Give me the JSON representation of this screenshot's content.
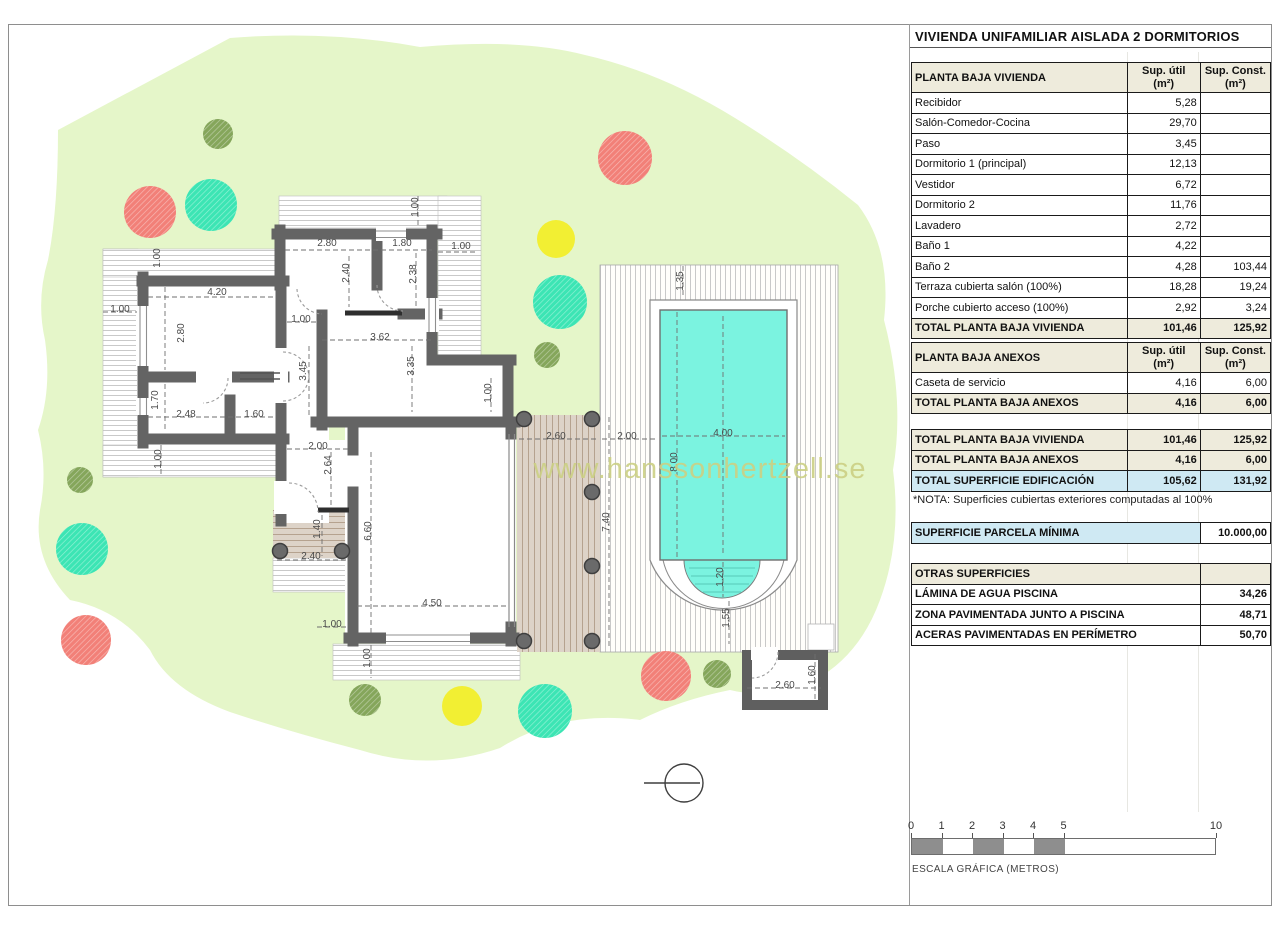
{
  "title": "VIVIENDA UNIFAMILIAR AISLADA 2 DORMITORIOS",
  "panel": {
    "vivienda": {
      "header": {
        "label": "PLANTA BAJA VIVIENDA",
        "col1": "Sup. útil\n(m²)",
        "col2": "Sup. Const.\n(m²)"
      },
      "rows": [
        [
          "Recibidor",
          "5,28",
          ""
        ],
        [
          "Salón-Comedor-Cocina",
          "29,70",
          ""
        ],
        [
          "Paso",
          "3,45",
          ""
        ],
        [
          "Dormitorio 1 (principal)",
          "12,13",
          ""
        ],
        [
          "Vestidor",
          "6,72",
          ""
        ],
        [
          "Dormitorio 2",
          "11,76",
          ""
        ],
        [
          "Lavadero",
          "2,72",
          ""
        ],
        [
          "Baño 1",
          "4,22",
          ""
        ],
        [
          "Baño 2",
          "4,28",
          "103,44"
        ],
        [
          "Terraza cubierta salón (100%)",
          "18,28",
          "19,24"
        ],
        [
          "Porche cubierto acceso (100%)",
          "2,92",
          "3,24"
        ]
      ],
      "total": [
        "TOTAL PLANTA BAJA VIVIENDA",
        "101,46",
        "125,92"
      ]
    },
    "anexos": {
      "header": {
        "label": "PLANTA BAJA ANEXOS",
        "col1": "Sup. útil\n(m²)",
        "col2": "Sup. Const.\n(m²)"
      },
      "rows": [
        [
          "Caseta de servicio",
          "4,16",
          "6,00"
        ]
      ],
      "total": [
        "TOTAL PLANTA BAJA ANEXOS",
        "4,16",
        "6,00"
      ]
    },
    "summary": [
      {
        "label": "TOTAL PLANTA BAJA VIVIENDA",
        "util": "101,46",
        "const": "125,92",
        "highlight": false
      },
      {
        "label": "TOTAL PLANTA BAJA ANEXOS",
        "util": "4,16",
        "const": "6,00",
        "highlight": false
      },
      {
        "label": "TOTAL SUPERFICIE EDIFICACIÓN",
        "util": "105,62",
        "const": "131,92",
        "highlight": true
      }
    ],
    "nota": "*NOTA: Superficies cubiertas exteriores computadas al 100%",
    "parcela": {
      "label": "SUPERFICIE PARCELA MÍNIMA",
      "value": "10.000,00"
    },
    "otras": {
      "header": "OTRAS SUPERFICIES",
      "rows": [
        [
          "LÁMINA DE AGUA PISCINA",
          "34,26"
        ],
        [
          "ZONA PAVIMENTADA JUNTO A PISCINA",
          "48,71"
        ],
        [
          "ACERAS PAVIMENTADAS EN PERÍMETRO",
          "50,70"
        ]
      ]
    }
  },
  "plan": {
    "watermark": "www.hanssonhertzell.se",
    "dimensions": [
      {
        "t": "1.00",
        "x": 160,
        "y": 258,
        "v": 1
      },
      {
        "t": "2.80",
        "x": 327,
        "y": 246,
        "v": 0
      },
      {
        "t": "1.80",
        "x": 402,
        "y": 246,
        "v": 0
      },
      {
        "t": "1.00",
        "x": 461,
        "y": 249,
        "v": 0
      },
      {
        "t": "1.00",
        "x": 418,
        "y": 207,
        "v": 1
      },
      {
        "t": "2.40",
        "x": 349,
        "y": 273,
        "v": 1
      },
      {
        "t": "2.38",
        "x": 416,
        "y": 274,
        "v": 1
      },
      {
        "t": "4.20",
        "x": 217,
        "y": 295,
        "v": 0
      },
      {
        "t": "1.00",
        "x": 120,
        "y": 312,
        "v": 0
      },
      {
        "t": "2.80",
        "x": 184,
        "y": 333,
        "v": 1
      },
      {
        "t": "3.62",
        "x": 380,
        "y": 340,
        "v": 0
      },
      {
        "t": "3.45",
        "x": 306,
        "y": 371,
        "v": 1
      },
      {
        "t": "3.35",
        "x": 414,
        "y": 366,
        "v": 1
      },
      {
        "t": "1.00",
        "x": 301,
        "y": 322,
        "v": 0
      },
      {
        "t": "1.70",
        "x": 158,
        "y": 400,
        "v": 1
      },
      {
        "t": "2.48",
        "x": 186,
        "y": 417,
        "v": 0
      },
      {
        "t": "1.60",
        "x": 254,
        "y": 417,
        "v": 0
      },
      {
        "t": "1.00",
        "x": 161,
        "y": 459,
        "v": 1
      },
      {
        "t": "2.00",
        "x": 318,
        "y": 449,
        "v": 0
      },
      {
        "t": "2.64",
        "x": 331,
        "y": 465,
        "v": 1
      },
      {
        "t": "1.40",
        "x": 320,
        "y": 529,
        "v": 1
      },
      {
        "t": "2.40",
        "x": 311,
        "y": 559,
        "v": 0
      },
      {
        "t": "6.60",
        "x": 371,
        "y": 531,
        "v": 1
      },
      {
        "t": "4.50",
        "x": 432,
        "y": 606,
        "v": 0
      },
      {
        "t": "1.00",
        "x": 332,
        "y": 627,
        "v": 0
      },
      {
        "t": "1.00",
        "x": 370,
        "y": 658,
        "v": 1
      },
      {
        "t": "1.00",
        "x": 491,
        "y": 393,
        "v": 1
      },
      {
        "t": "2.60",
        "x": 556,
        "y": 439,
        "v": 0
      },
      {
        "t": "2.00",
        "x": 627,
        "y": 439,
        "v": 0
      },
      {
        "t": "4.00",
        "x": 723,
        "y": 436,
        "v": 0
      },
      {
        "t": "1.35",
        "x": 683,
        "y": 281,
        "v": 1
      },
      {
        "t": "8.00",
        "x": 677,
        "y": 462,
        "v": 1
      },
      {
        "t": "7.40",
        "x": 609,
        "y": 522,
        "v": 1
      },
      {
        "t": "1.20",
        "x": 723,
        "y": 577,
        "v": 1
      },
      {
        "t": "1.55",
        "x": 729,
        "y": 618,
        "v": 1
      },
      {
        "t": "2.60",
        "x": 785,
        "y": 688,
        "v": 0
      },
      {
        "t": "1.60",
        "x": 815,
        "y": 675,
        "v": 1
      }
    ]
  },
  "scalebar": {
    "ticks": [
      0,
      1,
      2,
      3,
      4,
      5,
      10
    ],
    "meter_px": 30.5,
    "gray_segments": [
      [
        0,
        1
      ],
      [
        2,
        3
      ],
      [
        4,
        5
      ]
    ],
    "label": "ESCALA GRÁFICA (METROS)"
  },
  "colors": {
    "garden_green": "#e5f6c9",
    "pool_cyan": "#7bf3e0",
    "wall_gray": "#646464",
    "header_beige": "#eeebdc",
    "highlight_blue": "#cfe9f3",
    "tree_red": "#f28078",
    "tree_teal": "#3ce5b4",
    "tree_yellow": "#f2ef33",
    "tree_olive": "#85a65b",
    "watermark": "#ccd084",
    "terrace_tan": "#ddd3c8"
  }
}
